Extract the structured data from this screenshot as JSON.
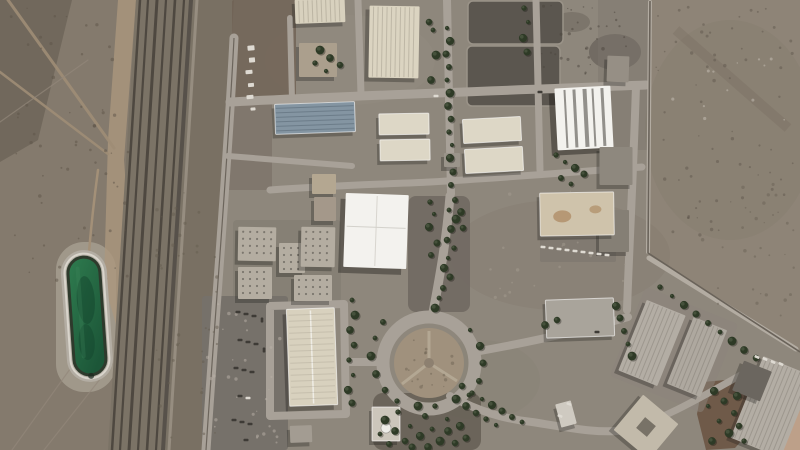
{
  "meta": {
    "type": "satellite-photograph",
    "description": "Overhead satellite view of a fenced desert industrial complex: a railway corridor and dirt tracks cross desert on the left, a green oval water reservoir sits beside the tracks, rows of cream and gray warehouse buildings fill the compound, a tree-lined roundabout anchors the lower center, parking lots hold rows of vehicles, and bare desert lies outside the diagonal perimeter fence at the upper right.",
    "width_px": 800,
    "height_px": 450
  },
  "palette": {
    "facility": "#8e877c",
    "desert_left": "#847a6d",
    "desert_left_dark": "#6d6457",
    "desert_right": "#8e8477",
    "desert_pink": "#c5a48c",
    "road": "#a8a198",
    "road_light": "#b3aca2",
    "rail_bed": "#7b7366",
    "rail_dark": "#4e4840",
    "dirt_tan": "#ab977d",
    "fence_dark": "#6a635a",
    "water": "#2a7a4e",
    "water_deep": "#1c5638",
    "rim": "#d8d4cb",
    "apron": "#b3ada3",
    "tree": "#2e3a26",
    "tree_light": "#55614a",
    "cream": "#d8d1be",
    "cream2": "#dbd4c1",
    "cream3": "#ddd7c6",
    "blue_roof": "#8495a2",
    "white_roof": "#f3f2ee",
    "tan_roof": "#cfc3ab",
    "gray_roof": "#a9a49b",
    "gray_ridge": "#b3ada4",
    "gray_light": "#b4ada1",
    "dark_yard": "#5b564f",
    "parking": "#76716a",
    "brown_dirt": "#6b5544",
    "car_white": "#dedad2",
    "car_dark": "#3e3b36"
  },
  "scene": {
    "buildings": [
      {
        "name": "warehouse-north-a",
        "cx": 320,
        "cy": 11,
        "w": 50,
        "h": 24,
        "rot": -2,
        "fill": "cream",
        "kind": "ridged-v"
      },
      {
        "name": "warehouse-north-large",
        "cx": 394,
        "cy": 42,
        "w": 50,
        "h": 72,
        "rot": 1,
        "fill": "cream2",
        "kind": "ridged-v",
        "shadow": [
          -4,
          4,
          0.32
        ]
      },
      {
        "name": "shed-cluster",
        "cx": 318,
        "cy": 60,
        "w": 38,
        "h": 34,
        "rot": 0,
        "fill": "#ab9f8d",
        "kind": "plain"
      },
      {
        "name": "warehouse-bluegray",
        "cx": 315,
        "cy": 118,
        "w": 80,
        "h": 30,
        "rot": -2,
        "fill": "blue_roof",
        "kind": "ridged-h",
        "border": true
      },
      {
        "name": "twin-bar-west-1",
        "cx": 404,
        "cy": 124,
        "w": 50,
        "h": 21,
        "rot": -1,
        "fill": "cream3",
        "kind": "plain",
        "border": true
      },
      {
        "name": "twin-bar-west-2",
        "cx": 405,
        "cy": 150,
        "w": 50,
        "h": 21,
        "rot": -1,
        "fill": "cream3",
        "kind": "plain",
        "border": true
      },
      {
        "name": "twin-bar-east-1",
        "cx": 492,
        "cy": 130,
        "w": 58,
        "h": 24,
        "rot": -3,
        "fill": "cream3",
        "kind": "plain",
        "border": true
      },
      {
        "name": "twin-bar-east-2",
        "cx": 494,
        "cy": 160,
        "w": 58,
        "h": 24,
        "rot": -3,
        "fill": "cream3",
        "kind": "plain",
        "border": true
      },
      {
        "name": "small-annex",
        "cx": 452,
        "cy": 160,
        "w": 16,
        "h": 14,
        "rot": 0,
        "fill": "#9a948a",
        "kind": "plain"
      },
      {
        "name": "warehouse-white-striped",
        "cx": 584,
        "cy": 118,
        "w": 56,
        "h": 62,
        "rot": -3,
        "fill": "white_roof",
        "kind": "striped",
        "shadow": [
          -6,
          5,
          0.45
        ]
      },
      {
        "name": "utility-square",
        "cx": 618,
        "cy": 69,
        "w": 22,
        "h": 26,
        "rot": 2,
        "fill": "#968f85",
        "kind": "plain"
      },
      {
        "name": "gray-block-a",
        "cx": 616,
        "cy": 166,
        "w": 33,
        "h": 38,
        "rot": 0,
        "fill": "#8e887e",
        "kind": "plain"
      },
      {
        "name": "gray-block-b",
        "cx": 614,
        "cy": 231,
        "w": 30,
        "h": 42,
        "rot": 0,
        "fill": "#857f75",
        "kind": "plain"
      },
      {
        "name": "warehouse-tan-stained",
        "cx": 577,
        "cy": 214,
        "w": 74,
        "h": 43,
        "rot": -1,
        "fill": "tan_roof",
        "kind": "stained",
        "border": true
      },
      {
        "name": "main-white-hall",
        "cx": 376,
        "cy": 231,
        "w": 63,
        "h": 74,
        "rot": 2,
        "fill": "white_roof",
        "kind": "panels",
        "shadow": [
          -5,
          6,
          0.4
        ]
      },
      {
        "name": "office-small-a",
        "cx": 324,
        "cy": 184,
        "w": 24,
        "h": 20,
        "rot": 0,
        "fill": "#b4a791",
        "kind": "plain"
      },
      {
        "name": "office-small-b",
        "cx": 325,
        "cy": 209,
        "w": 22,
        "h": 24,
        "rot": 0,
        "fill": "#a4988a",
        "kind": "plain"
      },
      {
        "name": "block-cluster-a",
        "cx": 257,
        "cy": 244,
        "w": 38,
        "h": 34,
        "rot": 1,
        "fill": "gray_light",
        "kind": "dotted"
      },
      {
        "name": "block-cluster-b",
        "cx": 292,
        "cy": 258,
        "w": 26,
        "h": 30,
        "rot": 0,
        "fill": "gray_light",
        "kind": "dotted"
      },
      {
        "name": "block-cluster-c",
        "cx": 255,
        "cy": 283,
        "w": 34,
        "h": 32,
        "rot": 0,
        "fill": "gray_light",
        "kind": "dotted"
      },
      {
        "name": "block-cluster-d",
        "cx": 318,
        "cy": 247,
        "w": 34,
        "h": 40,
        "rot": 1,
        "fill": "gray_light",
        "kind": "dotted"
      },
      {
        "name": "block-cluster-e",
        "cx": 313,
        "cy": 288,
        "w": 38,
        "h": 26,
        "rot": 0,
        "fill": "gray_light",
        "kind": "dotted"
      },
      {
        "name": "long-hall-south",
        "cx": 312,
        "cy": 357,
        "w": 48,
        "h": 97,
        "rot": -2,
        "fill": "cream",
        "kind": "ridge-center",
        "border": true,
        "shadow": [
          -4,
          5,
          0.35
        ]
      },
      {
        "name": "long-hall-wing",
        "cx": 301,
        "cy": 434,
        "w": 22,
        "h": 17,
        "rot": -2,
        "fill": "#a39c92",
        "kind": "plain"
      },
      {
        "name": "warehouse-east-flat",
        "cx": 580,
        "cy": 318,
        "w": 68,
        "h": 38,
        "rot": -2,
        "fill": "gray_roof",
        "kind": "plain",
        "border": true
      },
      {
        "name": "warehouse-tilted-a",
        "cx": 652,
        "cy": 343,
        "w": 42,
        "h": 76,
        "rot": 22,
        "fill": "gray_ridge",
        "kind": "ridged-v"
      },
      {
        "name": "warehouse-tilted-b",
        "cx": 697,
        "cy": 357,
        "w": 36,
        "h": 72,
        "rot": 22,
        "fill": "#aea89f",
        "kind": "ridged-v"
      },
      {
        "name": "warehouse-southeast",
        "cx": 772,
        "cy": 407,
        "w": 54,
        "h": 88,
        "rot": 22,
        "fill": "gray_ridge",
        "kind": "ridged-v"
      },
      {
        "name": "dark-annex-southeast",
        "cx": 752,
        "cy": 381,
        "w": 30,
        "h": 32,
        "rot": 22,
        "fill": "#6b665f",
        "kind": "plain"
      },
      {
        "name": "courtyard-diamond",
        "cx": 646,
        "cy": 427,
        "w": 46,
        "h": 46,
        "rot": 40,
        "fill": "#c2baaa",
        "kind": "hole"
      },
      {
        "name": "mosque",
        "cx": 386,
        "cy": 424,
        "w": 28,
        "h": 34,
        "rot": 0,
        "fill": "#ccc6bb",
        "kind": "dome",
        "border": true
      },
      {
        "name": "kiosk-south",
        "cx": 566,
        "cy": 414,
        "w": 16,
        "h": 24,
        "rot": -15,
        "fill": "#cfcac1",
        "kind": "plain"
      }
    ],
    "trees": [
      [
        447,
        28
      ],
      [
        450,
        41
      ],
      [
        446,
        54
      ],
      [
        449,
        67
      ],
      [
        447,
        80
      ],
      [
        450,
        93
      ],
      [
        448,
        106
      ],
      [
        451,
        119
      ],
      [
        449,
        132
      ],
      [
        452,
        145
      ],
      [
        450,
        158
      ],
      [
        453,
        172
      ],
      [
        451,
        185
      ],
      [
        433,
        30
      ],
      [
        436,
        55
      ],
      [
        431,
        80
      ],
      [
        429,
        22
      ],
      [
        524,
        8
      ],
      [
        528,
        22
      ],
      [
        523,
        38
      ],
      [
        527,
        52
      ],
      [
        455,
        200
      ],
      [
        449,
        210
      ],
      [
        456,
        219
      ],
      [
        451,
        229
      ],
      [
        447,
        240
      ],
      [
        454,
        248
      ],
      [
        448,
        258
      ],
      [
        444,
        268
      ],
      [
        450,
        277
      ],
      [
        443,
        288
      ],
      [
        439,
        298
      ],
      [
        435,
        308
      ],
      [
        461,
        212
      ],
      [
        463,
        228
      ],
      [
        430,
        202
      ],
      [
        434,
        214
      ],
      [
        429,
        227
      ],
      [
        437,
        243
      ],
      [
        431,
        255
      ],
      [
        352,
        300
      ],
      [
        355,
        315
      ],
      [
        350,
        330
      ],
      [
        354,
        345
      ],
      [
        349,
        360
      ],
      [
        353,
        375
      ],
      [
        348,
        390
      ],
      [
        352,
        403
      ],
      [
        383,
        322
      ],
      [
        375,
        338
      ],
      [
        371,
        356
      ],
      [
        376,
        374
      ],
      [
        385,
        390
      ],
      [
        397,
        401
      ],
      [
        470,
        330
      ],
      [
        480,
        346
      ],
      [
        483,
        363
      ],
      [
        479,
        381
      ],
      [
        469,
        395
      ],
      [
        385,
        420
      ],
      [
        395,
        431
      ],
      [
        405,
        441
      ],
      [
        398,
        412
      ],
      [
        410,
        426
      ],
      [
        420,
        436
      ],
      [
        412,
        447
      ],
      [
        425,
        416
      ],
      [
        432,
        429
      ],
      [
        440,
        441
      ],
      [
        448,
        431
      ],
      [
        455,
        443
      ],
      [
        435,
        406
      ],
      [
        447,
        419
      ],
      [
        460,
        426
      ],
      [
        466,
        438
      ],
      [
        389,
        444
      ],
      [
        380,
        434
      ],
      [
        418,
        406
      ],
      [
        428,
        447
      ],
      [
        462,
        386
      ],
      [
        472,
        393
      ],
      [
        482,
        399
      ],
      [
        492,
        405
      ],
      [
        502,
        411
      ],
      [
        512,
        417
      ],
      [
        522,
        422
      ],
      [
        456,
        399
      ],
      [
        466,
        406
      ],
      [
        476,
        413
      ],
      [
        486,
        419
      ],
      [
        496,
        425
      ],
      [
        616,
        306
      ],
      [
        620,
        318
      ],
      [
        624,
        331
      ],
      [
        628,
        344
      ],
      [
        632,
        356
      ],
      [
        545,
        325
      ],
      [
        557,
        320
      ],
      [
        660,
        287
      ],
      [
        672,
        296
      ],
      [
        684,
        305
      ],
      [
        696,
        314
      ],
      [
        708,
        323
      ],
      [
        720,
        332
      ],
      [
        732,
        341
      ],
      [
        744,
        350
      ],
      [
        756,
        358
      ],
      [
        556,
        155
      ],
      [
        565,
        162
      ],
      [
        575,
        168
      ],
      [
        584,
        174
      ],
      [
        561,
        178
      ],
      [
        571,
        184
      ],
      [
        320,
        50
      ],
      [
        330,
        58
      ],
      [
        340,
        65
      ],
      [
        315,
        63
      ],
      [
        326,
        71
      ],
      [
        714,
        391
      ],
      [
        724,
        401
      ],
      [
        734,
        413
      ],
      [
        719,
        421
      ],
      [
        729,
        433
      ],
      [
        712,
        441
      ],
      [
        739,
        426
      ],
      [
        744,
        441
      ],
      [
        708,
        406
      ],
      [
        737,
        396
      ]
    ],
    "cars": [
      [
        251,
        48,
        -5,
        "w",
        7,
        5
      ],
      [
        252,
        60,
        -5,
        "w",
        6,
        5
      ],
      [
        249,
        72,
        -5,
        "w",
        7,
        4
      ],
      [
        251,
        85,
        -5,
        "w",
        6,
        4
      ],
      [
        250,
        97,
        -5,
        "w",
        7,
        4
      ],
      [
        253,
        109,
        -5,
        "w",
        5,
        3
      ],
      [
        238,
        312,
        0,
        "d"
      ],
      [
        246,
        314,
        0,
        "d"
      ],
      [
        254,
        316,
        0,
        "d"
      ],
      [
        240,
        340,
        0,
        "d"
      ],
      [
        248,
        342,
        0,
        "d"
      ],
      [
        256,
        344,
        0,
        "d"
      ],
      [
        236,
        368,
        0,
        "d"
      ],
      [
        244,
        370,
        0,
        "d"
      ],
      [
        252,
        372,
        0,
        "d"
      ],
      [
        240,
        396,
        0,
        "d"
      ],
      [
        248,
        398,
        0,
        "w"
      ],
      [
        234,
        420,
        0,
        "d"
      ],
      [
        242,
        422,
        0,
        "d"
      ],
      [
        250,
        424,
        0,
        "d"
      ],
      [
        246,
        440,
        0,
        "d"
      ],
      [
        262,
        320,
        90,
        "d"
      ],
      [
        264,
        350,
        90,
        "d"
      ],
      [
        543,
        247,
        4,
        "w"
      ],
      [
        551,
        248,
        4,
        "w"
      ],
      [
        559,
        249,
        4,
        "w"
      ],
      [
        567,
        250,
        4,
        "w"
      ],
      [
        575,
        251,
        4,
        "w"
      ],
      [
        583,
        252,
        4,
        "w"
      ],
      [
        591,
        253,
        4,
        "w"
      ],
      [
        599,
        254,
        4,
        "w"
      ],
      [
        607,
        255,
        4,
        "w"
      ],
      [
        757,
        357,
        25,
        "w"
      ],
      [
        765,
        359,
        25,
        "w"
      ],
      [
        773,
        362,
        25,
        "w"
      ],
      [
        781,
        364,
        25,
        "w"
      ],
      [
        436,
        96,
        0,
        "w"
      ],
      [
        540,
        92,
        0,
        "d"
      ],
      [
        569,
        404,
        20,
        "w"
      ],
      [
        560,
        416,
        20,
        "w"
      ],
      [
        597,
        332,
        0,
        "d"
      ]
    ],
    "speckles": [
      {
        "name": "desert-right-speckle",
        "x": 655,
        "y": 5,
        "w": 140,
        "h": 230,
        "n": 70,
        "color": "#5f584e"
      },
      {
        "name": "desert-left-speckle",
        "x": 2,
        "y": 2,
        "w": 130,
        "h": 280,
        "n": 60,
        "color": "#5e5448"
      },
      {
        "name": "left-scrub-speckle",
        "x": 150,
        "y": 180,
        "w": 70,
        "h": 260,
        "n": 40,
        "color": "#665d50"
      },
      {
        "name": "parking-speckle",
        "x": 205,
        "y": 300,
        "w": 75,
        "h": 145,
        "n": 30,
        "color": "#b9b2a8"
      },
      {
        "name": "roundabout-scrub",
        "x": 404,
        "y": 338,
        "w": 50,
        "h": 50,
        "n": 18,
        "color": "#6e6454"
      },
      {
        "name": "facility-light-speckle",
        "x": 470,
        "y": 190,
        "w": 160,
        "h": 110,
        "n": 25,
        "color": "#a39b90"
      },
      {
        "name": "desert-right-lower-speckle",
        "x": 690,
        "y": 180,
        "w": 105,
        "h": 150,
        "n": 30,
        "color": "#6a6156"
      },
      {
        "name": "debris-speckle",
        "x": 540,
        "y": 5,
        "w": 100,
        "h": 70,
        "n": 35,
        "color": "#4c463e"
      },
      {
        "name": "bright-debris-speckle",
        "x": 660,
        "y": 20,
        "w": 130,
        "h": 100,
        "n": 12,
        "color": "#c8c2b8"
      }
    ]
  }
}
